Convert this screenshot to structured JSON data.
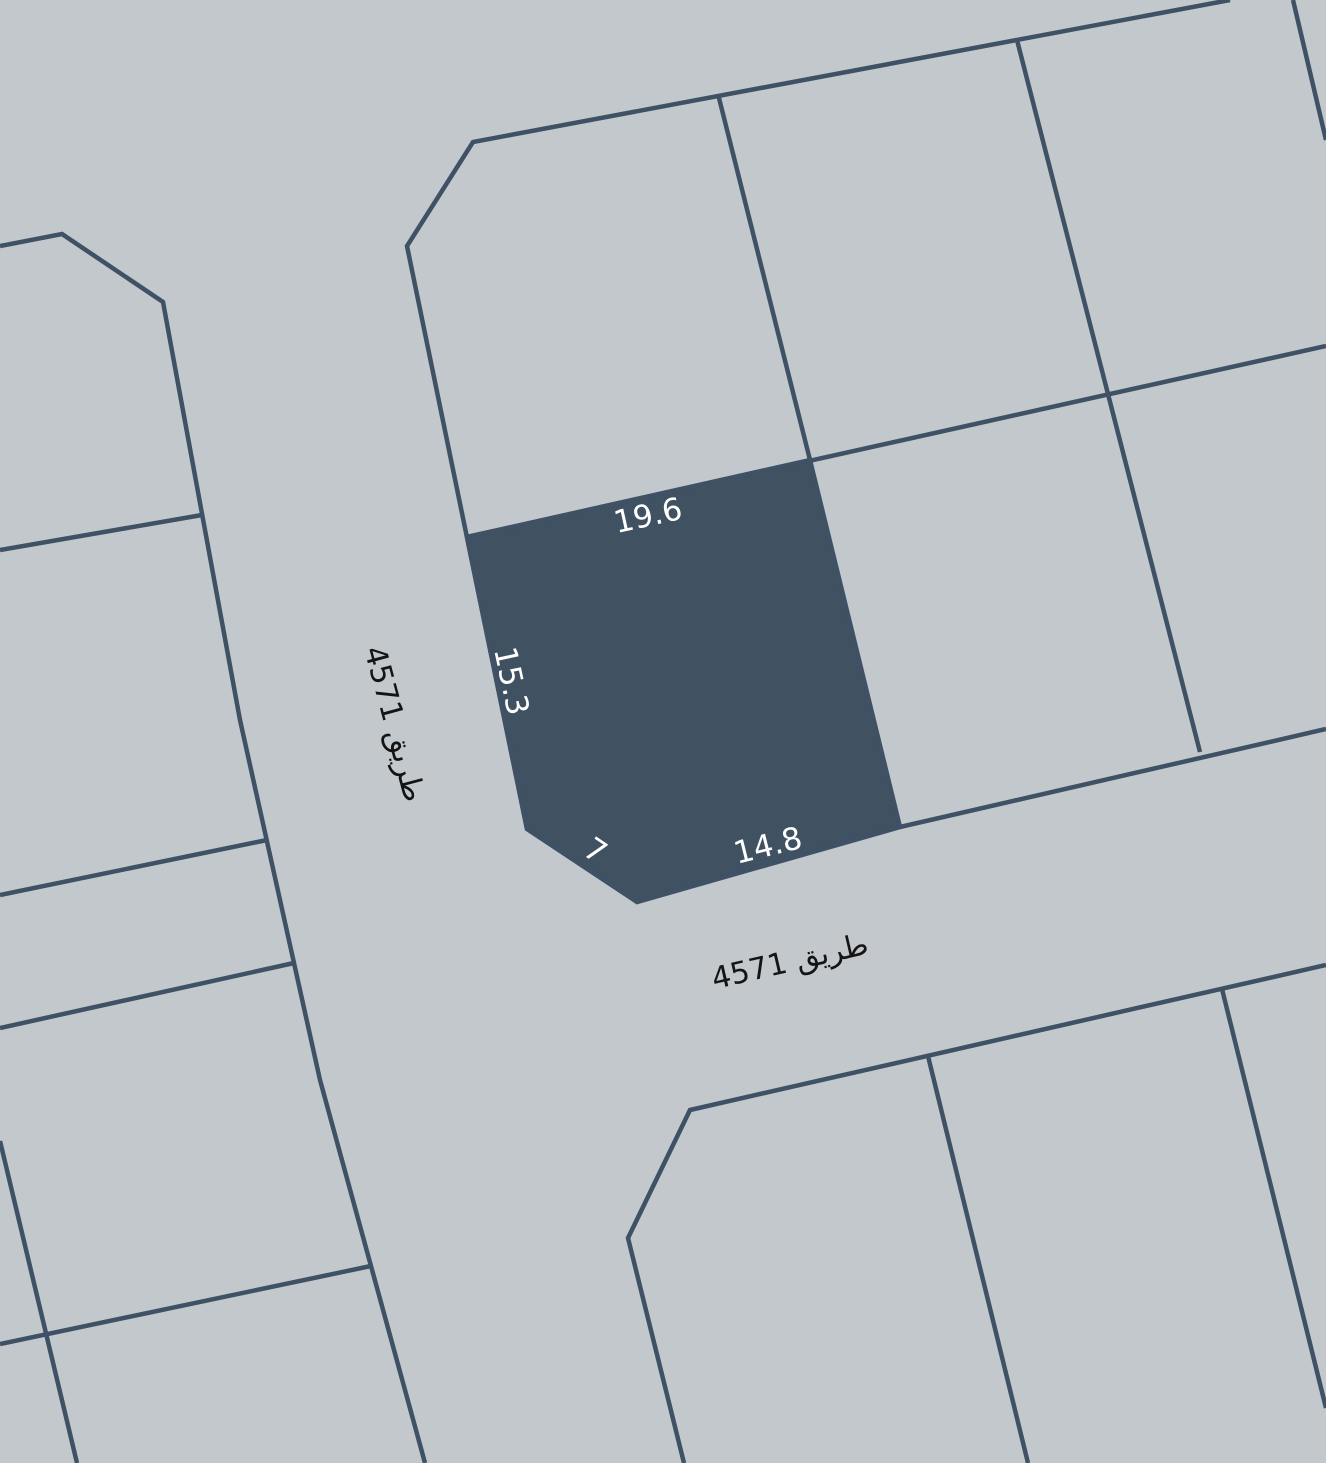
{
  "colors": {
    "map-bg": "#c3c8cc",
    "boundary-line": "#3f5165",
    "parcel-fill": "#405162",
    "dimension-text": "#ffffff",
    "road-text": "#141414"
  },
  "selected_parcel": {
    "dimension_labels": {
      "top": "19.6",
      "left": "15.3",
      "bottom": "14.8",
      "chamfer": "7"
    }
  },
  "roads": {
    "left_road_label": "طريق 4571",
    "bottom_road_label": "طريق 4571"
  }
}
